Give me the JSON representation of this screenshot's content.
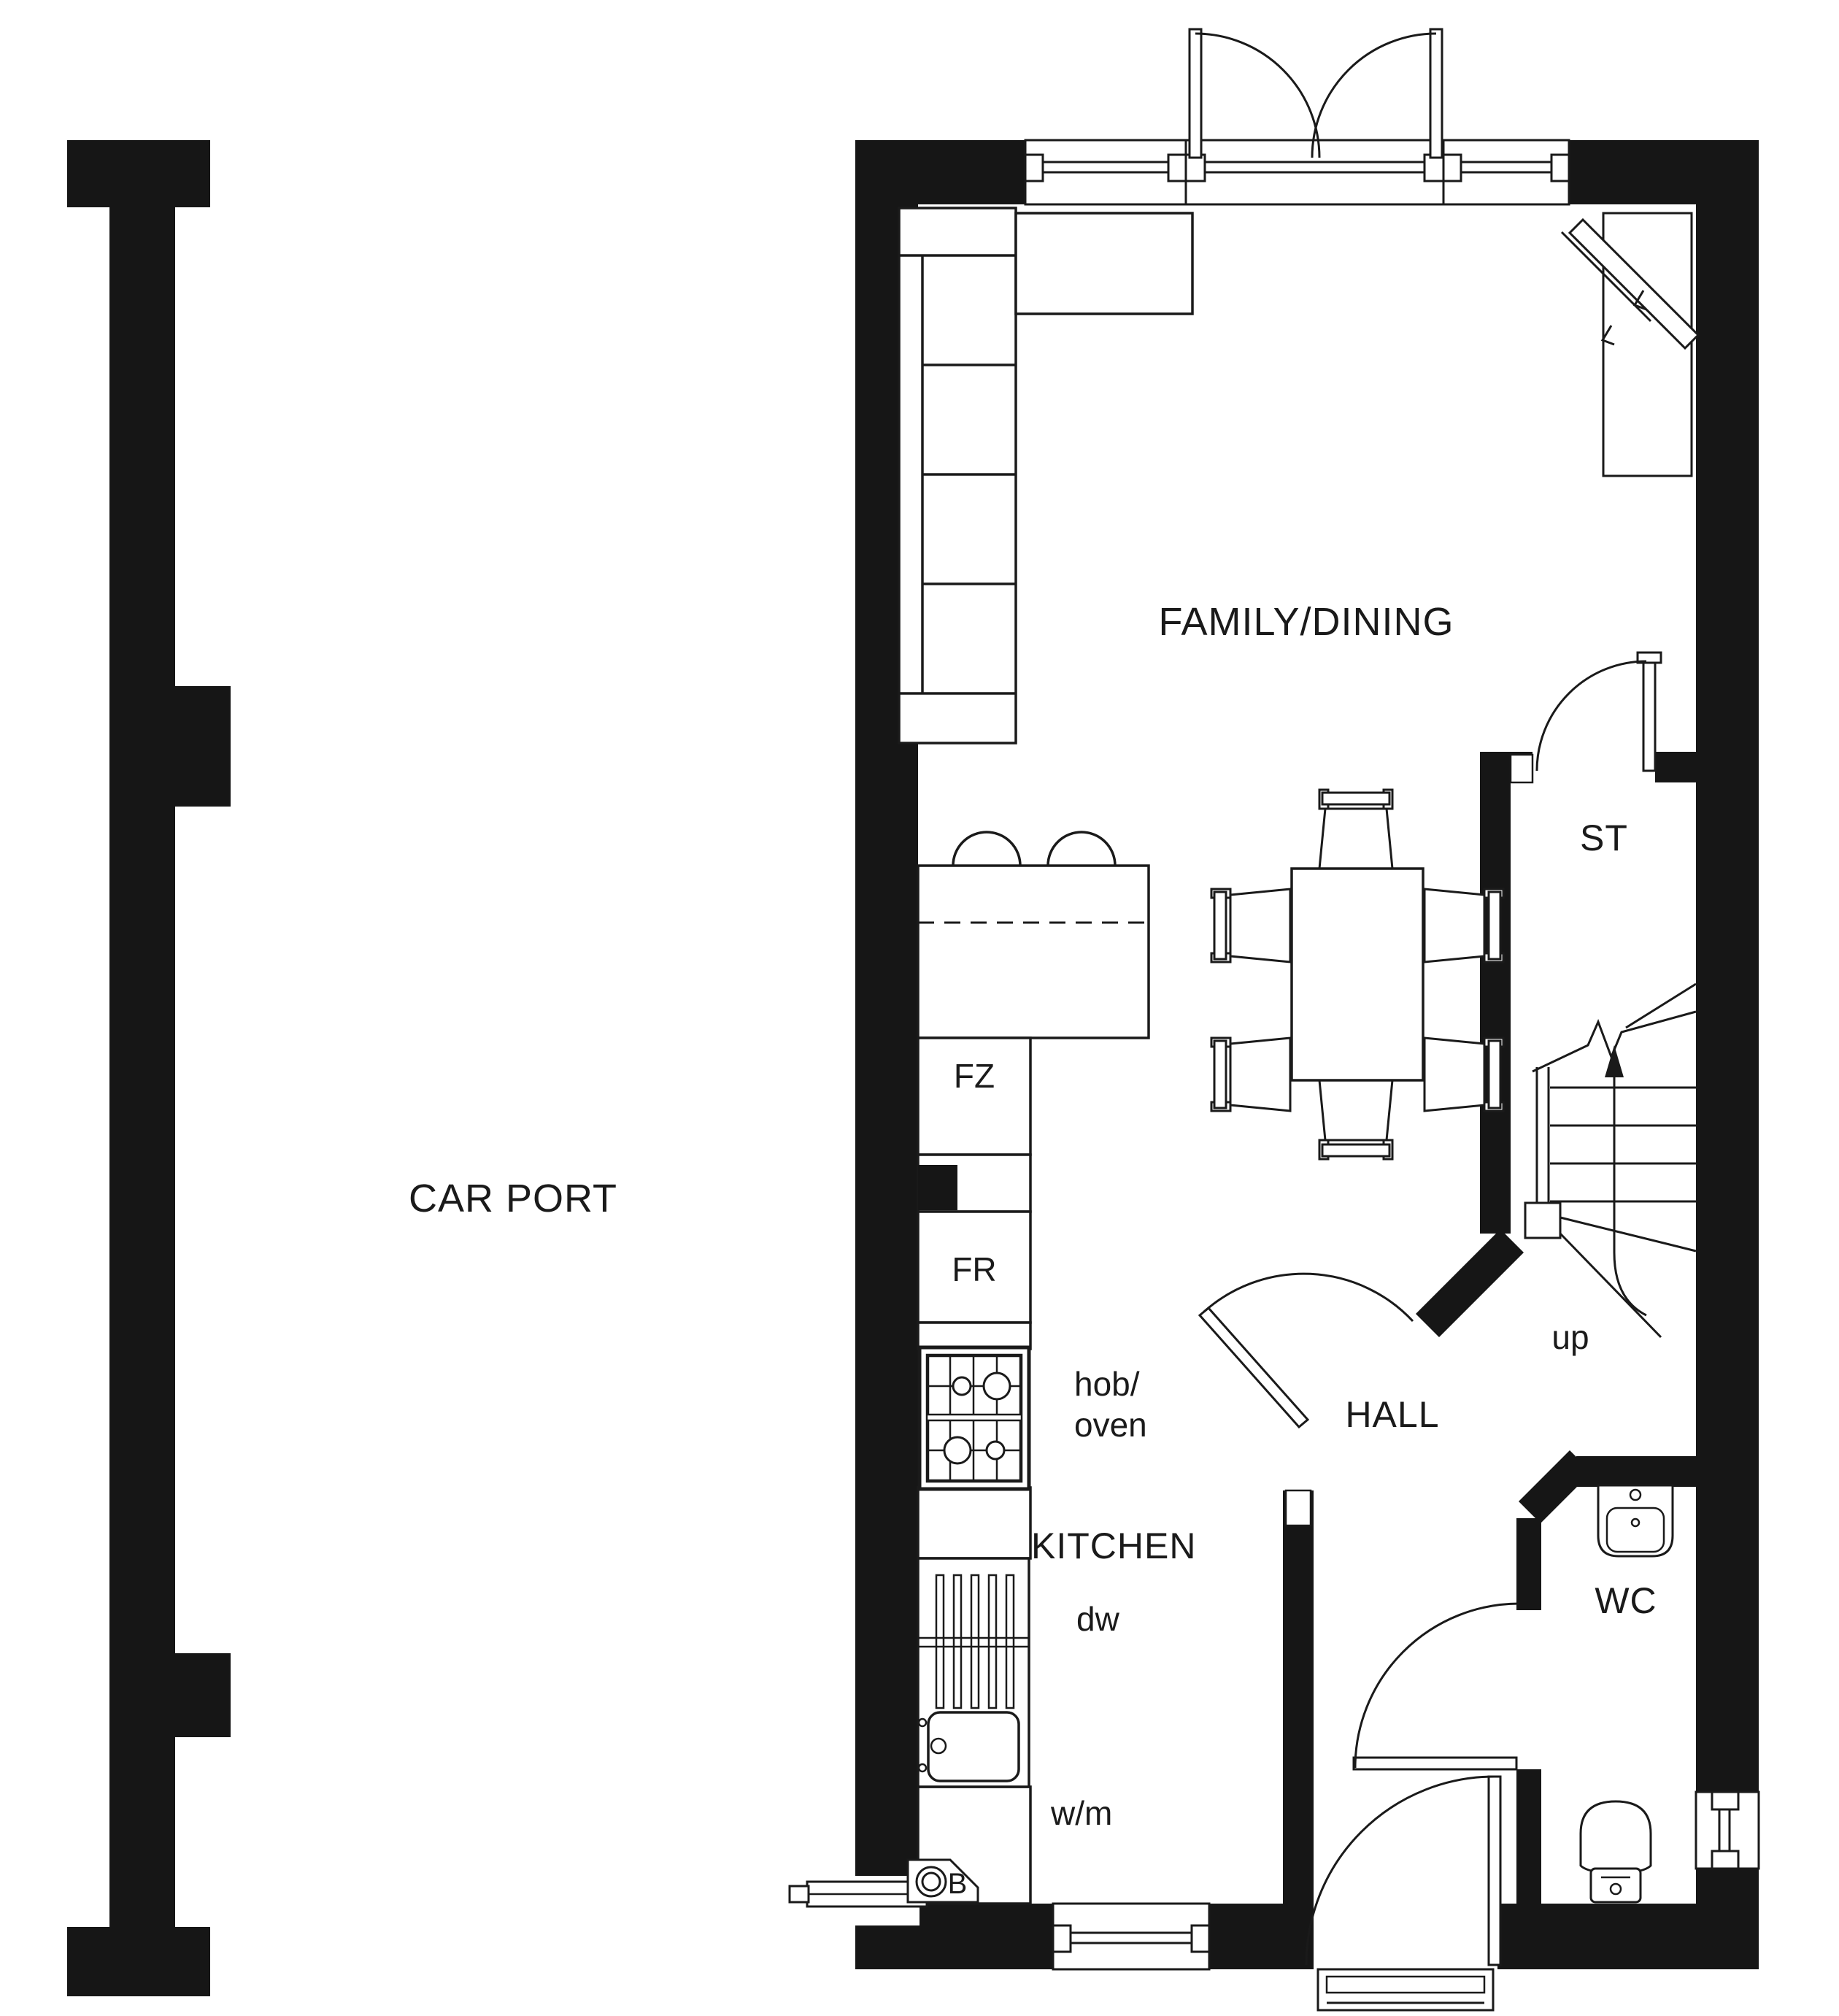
{
  "plan": {
    "rooms": {
      "car_port": "CAR PORT",
      "family_dining": "FAMILY/DINING",
      "kitchen": "KITCHEN",
      "hall": "HALL",
      "store": "ST",
      "wc": "WC"
    },
    "labels": {
      "freezer": "FZ",
      "fridge": "FR",
      "hob_line1": "hob/",
      "hob_line2": "oven",
      "dishwasher": "dw",
      "washing_machine": "w/m",
      "stairs_up": "up",
      "boiler": "B"
    },
    "colors": {
      "wall": "#161616",
      "line": "#1a1a1a",
      "background": "#ffffff"
    }
  }
}
